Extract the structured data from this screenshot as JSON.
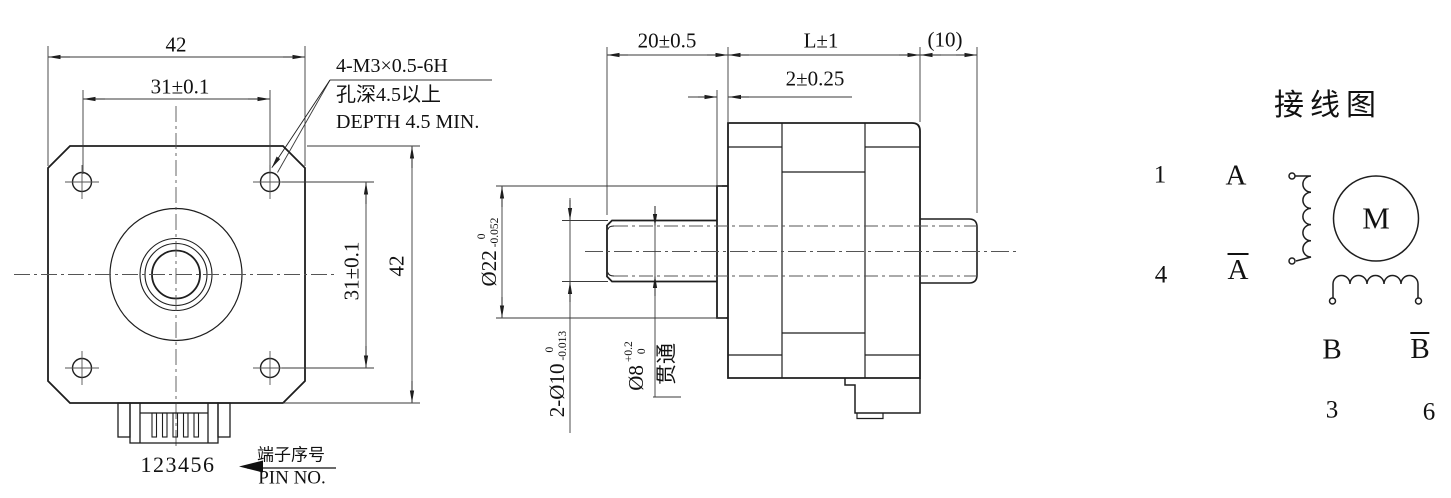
{
  "title": "Stepper motor outline drawing",
  "colors": {
    "background": "#ffffff",
    "line": "#1e1e1e",
    "text": "#111111"
  },
  "front_view": {
    "dim_width_top": "42",
    "dim_hole_pitch_top": "31±0.1",
    "thread_callout": {
      "line1": "4-M3×0.5-6H",
      "line2": "孔深4.5以上",
      "line3": "DEPTH 4.5 MIN."
    },
    "dim_hole_pitch_right": "31±0.1",
    "dim_height_right": "42",
    "pin_numbers": "123456",
    "pin_label_cn": "端子序号",
    "pin_label_en": "PIN NO."
  },
  "side_view": {
    "dim_front_shaft_length": "20±0.5",
    "dim_body_length": "L±1",
    "dim_rear_shaft_length": "(10)",
    "dim_pilot_height": "2±0.25",
    "dim_pilot_dia": {
      "main": "Ø22",
      "upper": "0",
      "lower": "-0.052"
    },
    "dim_shaft_dia": {
      "main": "2-Ø10",
      "upper": "0",
      "lower": "-0.013"
    },
    "dim_bore_dia": {
      "main": "Ø8",
      "upper": "+0.2",
      "lower": "0"
    },
    "bore_note": "贯通"
  },
  "wiring": {
    "title": "接线图",
    "motor_label": "M",
    "pin_1": "1",
    "pin_4": "4",
    "pin_3": "3",
    "pin_6": "6",
    "phase_a": "A",
    "phase_a_bar": "A",
    "phase_b": "B",
    "phase_b_bar": "B"
  }
}
